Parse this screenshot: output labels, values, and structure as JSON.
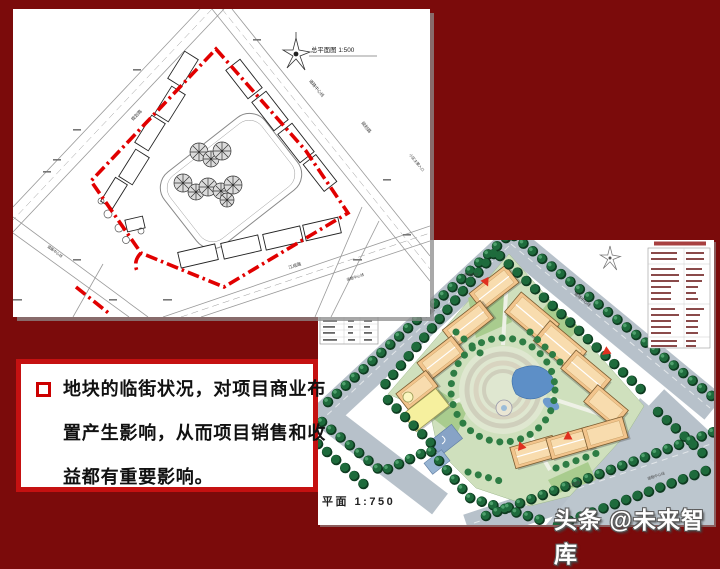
{
  "slide": {
    "background_color": "#7b0b0b",
    "watermark": "头条 @未来智库"
  },
  "cad_plan": {
    "title": "总平面图 1:500",
    "labels": {
      "road_center": "道路中心线",
      "planning_road": "规划路",
      "jiangcheng_road": "江成路",
      "main_entrance": "小区主要入口"
    },
    "boundary_color": "#e10000"
  },
  "color_plan": {
    "caption": "平面 1:750",
    "labels": {
      "road_center": "道路中心线",
      "planning_road": "规划路",
      "jiangcheng_road": "江成路",
      "garage_exit": "车库出口"
    },
    "tree_color": "#1e6b3c",
    "building_color": "#f2c48c",
    "road_color": "#b7c1ca"
  },
  "text_box": {
    "lines": [
      "地块的临街状况，对项目商业布",
      "置产生影响，从而项目销售和收",
      "益都有重要影响。"
    ]
  }
}
